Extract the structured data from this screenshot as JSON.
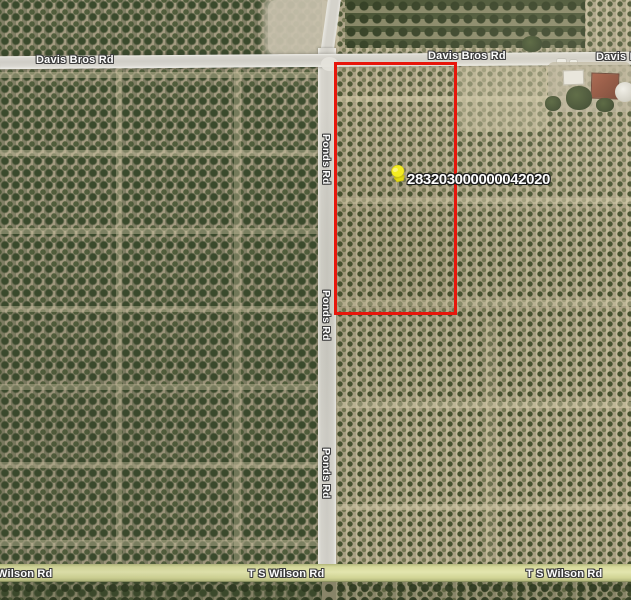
{
  "map": {
    "kind": "aerial-parcel-map",
    "parcel": {
      "id_label": "283203000000042020",
      "outline_color": "#e7160b",
      "pin_color": "#f4ec22"
    },
    "road_labels": {
      "davis_left": "Davis Bros Rd",
      "davis_center": "Davis Bros Rd",
      "davis_right": "Davis B",
      "ponds_1": "Ponds Rd",
      "ponds_2": "Ponds Rd",
      "ponds_3": "Ponds Rd",
      "wilson_left": "Wilson Rd",
      "wilson_center": "T S Wilson Rd",
      "wilson_right": "T S Wilson Rd"
    },
    "colors": {
      "label_text": "#ffffff",
      "label_outline": "#3d3d3d",
      "road_fill": "#d0cec7",
      "wilson_road_fill": "#e3e5ae",
      "soil_left": "#9c937b",
      "soil_right": "#b1a78b",
      "tree_dark": "#3a4a2c"
    }
  }
}
